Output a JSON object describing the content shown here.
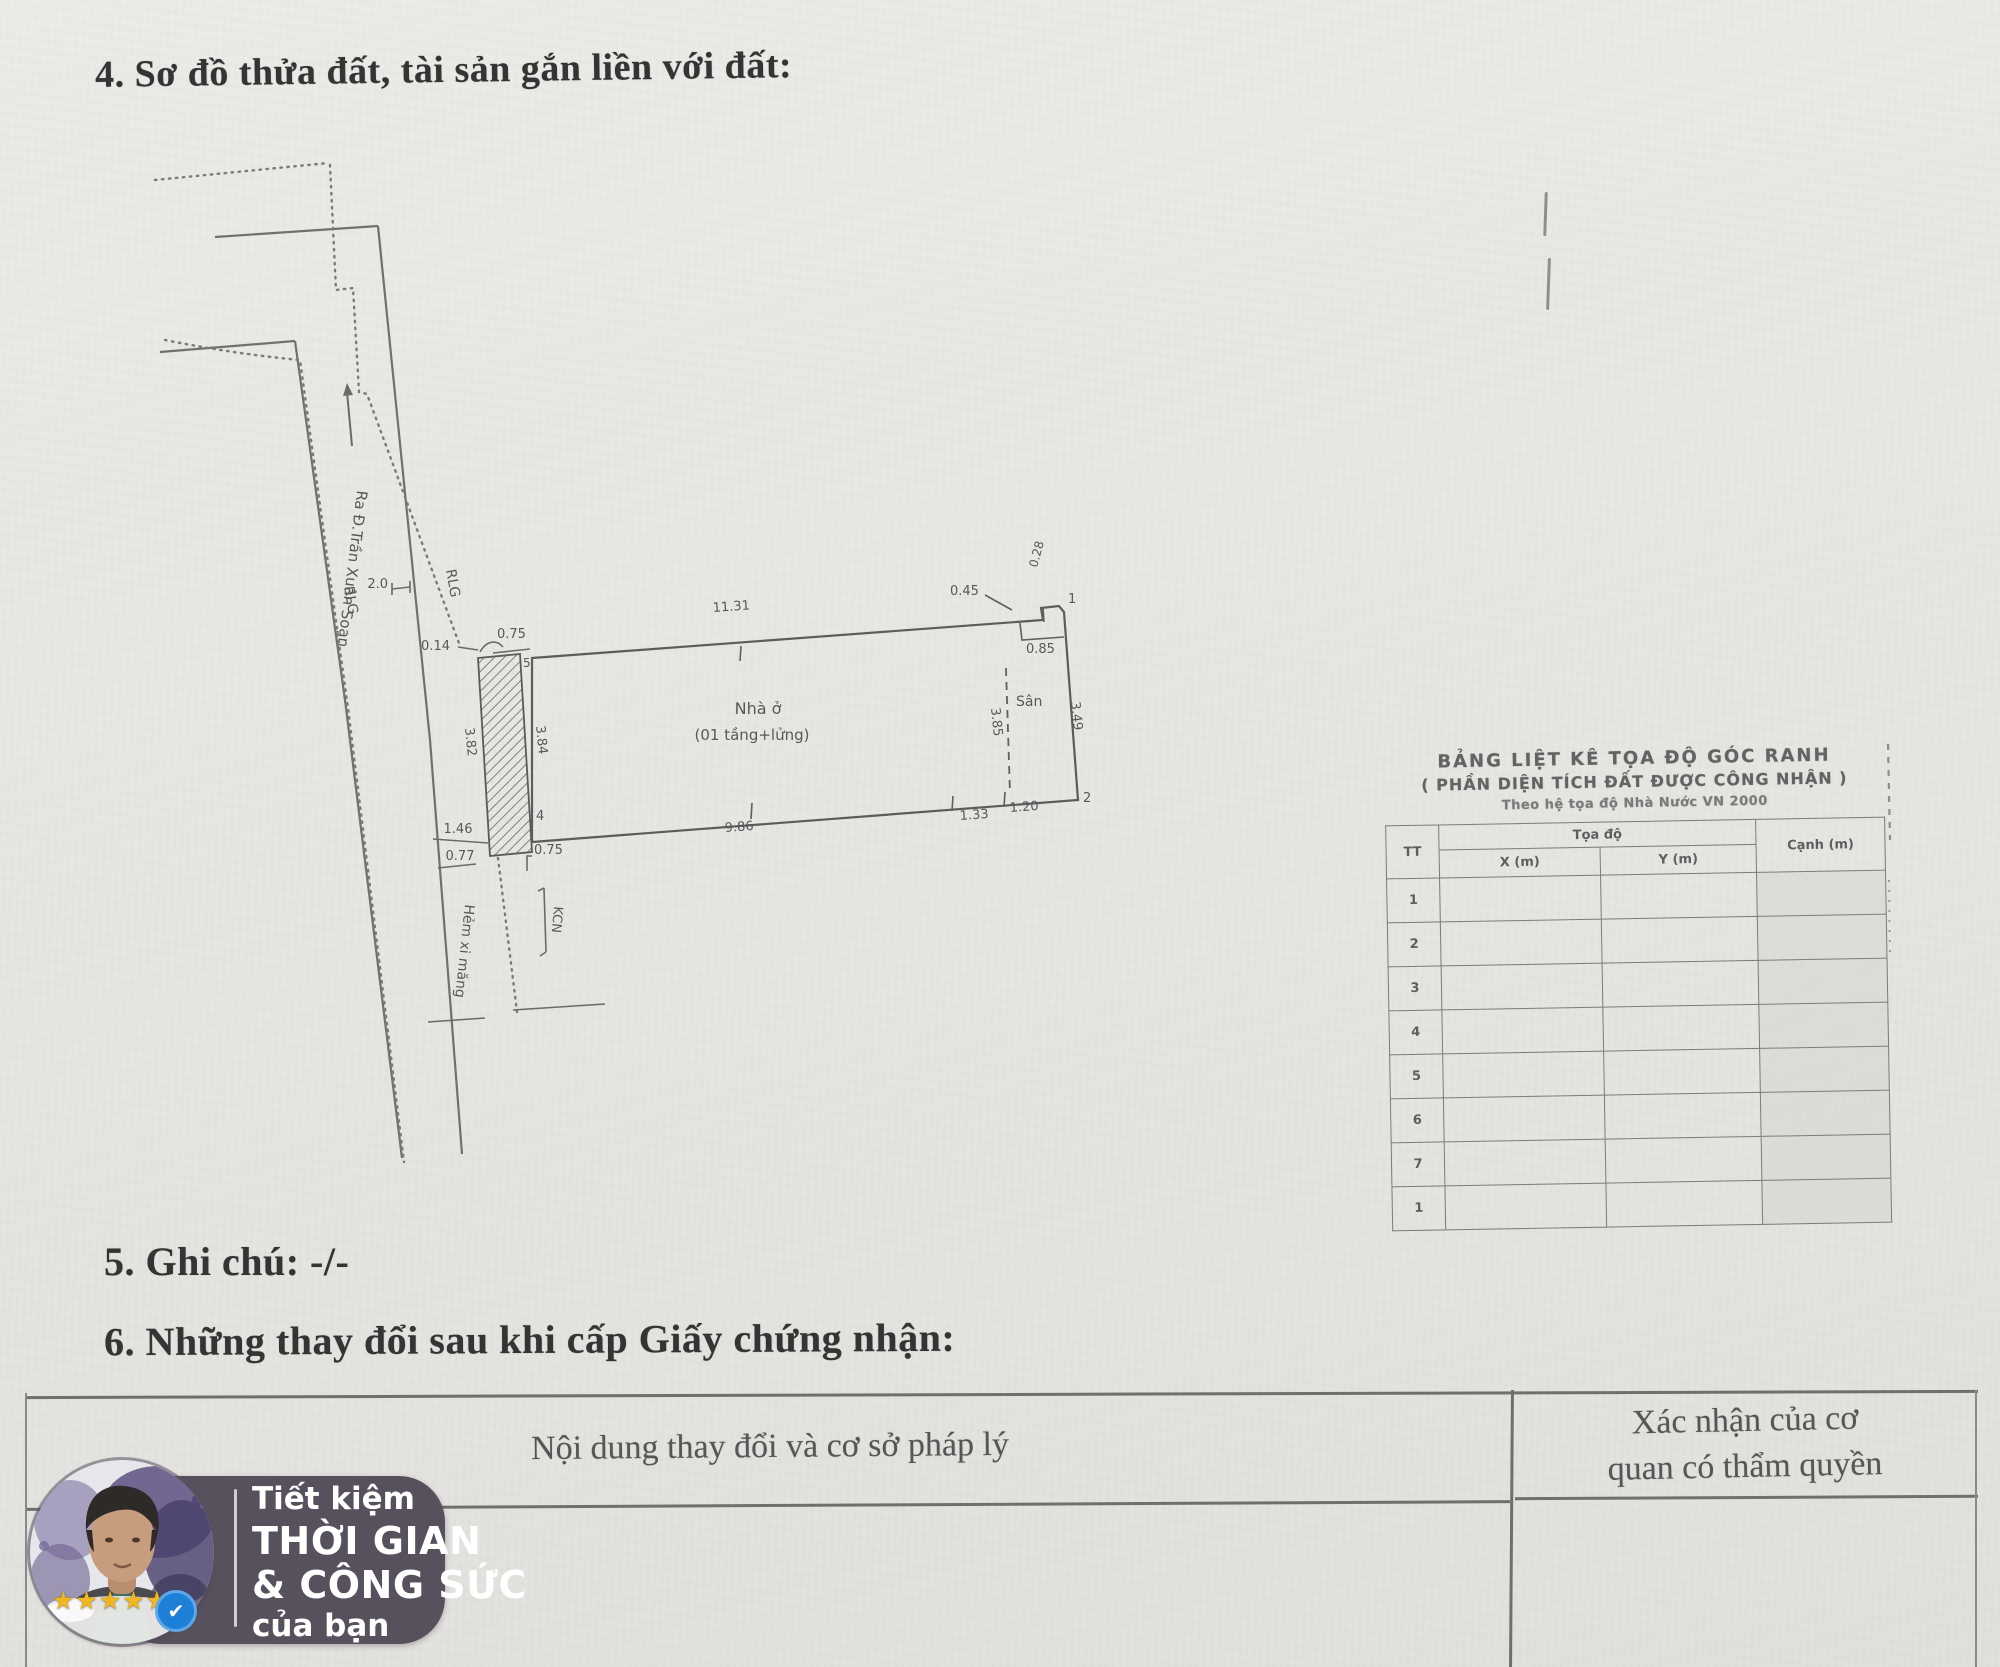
{
  "page": {
    "bg": "#e9e7e4",
    "ink": "#3b3b3b"
  },
  "sections": {
    "s4_title": "4. Sơ đồ thửa đất, tài sản gắn liền với đất:",
    "s5_title": "5. Ghi chú: -/-",
    "s6_title": "6. Những thay đổi sau khi cấp Giấy chứng nhận:"
  },
  "diagram": {
    "labels": {
      "street": "Ra Đ.Trần Xuân Soạn",
      "rlg": "RLG",
      "alley": "Hẻm xi măng",
      "kcn": "KCN",
      "house1": "Nhà ở",
      "house2": "(01 tầng+lửng)",
      "san": "Sân"
    },
    "dims": {
      "d20": "2.0",
      "d014": "0.14",
      "d075_top": "0.75",
      "d1131": "11.31",
      "d045": "0.45",
      "d028": "0.28",
      "d085": "0.85",
      "d349": "3.49",
      "d385": "3.85",
      "d384": "3.84",
      "d382": "3.82",
      "d986": "9.86",
      "d133": "1.33",
      "d120": "1.20",
      "d146": "1.46",
      "d077": "0.77",
      "d075_bot": "0.75"
    },
    "points": {
      "p1": "1",
      "p2": "2",
      "p4": "4",
      "p5": "5"
    }
  },
  "coord_table": {
    "title1": "BẢNG LIỆT KÊ TỌA ĐỘ GÓC RANH",
    "title2": "( PHẦN DIỆN TÍCH ĐẤT ĐƯỢC CÔNG NHẬN )",
    "title3": "Theo hệ tọa độ Nhà Nước VN 2000",
    "col_tt": "TT",
    "col_toado": "Tọa độ",
    "col_x": "X (m)",
    "col_y": "Y (m)",
    "col_canh": "Cạnh (m)",
    "rows": [
      "1",
      "2",
      "3",
      "4",
      "5",
      "6",
      "7",
      "1"
    ]
  },
  "changes_table": {
    "col_left": "Nội dung thay đổi và cơ sở pháp lý",
    "col_right_line1": "Xác nhận của cơ",
    "col_right_line2": "quan có thẩm quyền"
  },
  "watermark": {
    "line1": "Tiết kiệm",
    "line2": "THỜI GIAN",
    "line3": "& CÔNG SỨC",
    "line4": "của bạn",
    "stars": "★★★★★",
    "check": "✔",
    "badge_bg": "#57515d",
    "check_color": "#1d7fd6",
    "star_color": "#f2b61e"
  }
}
